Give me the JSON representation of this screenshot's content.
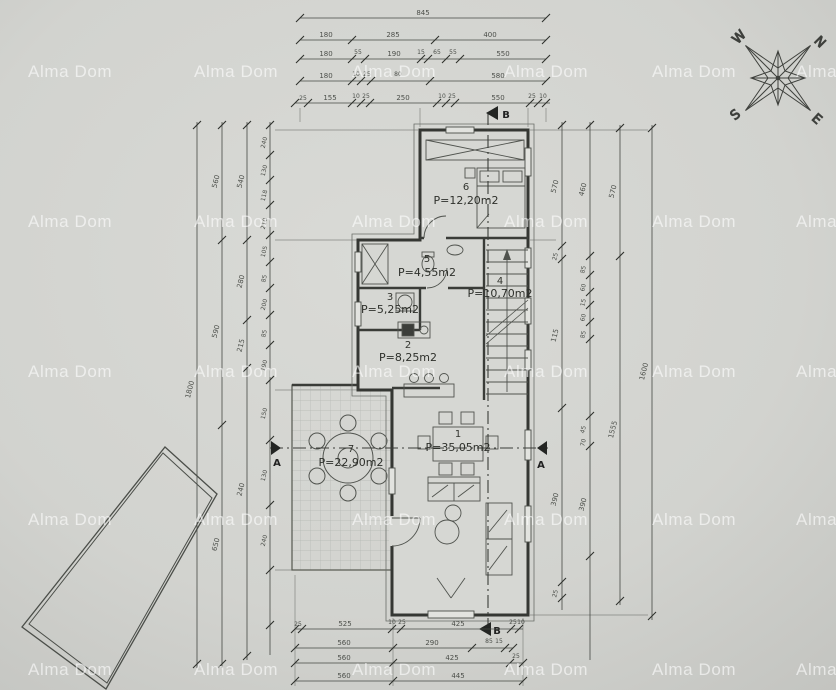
{
  "watermark": {
    "text": "Alma Dom"
  },
  "compass": {
    "n": "N",
    "w": "W",
    "s": "S",
    "e": "E"
  },
  "sections": {
    "b_top": "B",
    "b_bottom": "B",
    "a_left": "A",
    "a_right": "A"
  },
  "rooms": {
    "r1": {
      "num": "1",
      "area": "P=35,05m2"
    },
    "r2": {
      "num": "2",
      "area": "P=8,25m2"
    },
    "r3": {
      "num": "3",
      "area": "P=5,25m2"
    },
    "r4": {
      "num": "4",
      "area": "P=10,70m2"
    },
    "r5": {
      "num": "5",
      "area": "P=4,55m2"
    },
    "r6": {
      "num": "6",
      "area": "P=12,20m2"
    },
    "r7": {
      "num": "7",
      "area": "P=22,90m2"
    }
  },
  "dims": {
    "top1": [
      "845"
    ],
    "top2": [
      "180",
      "285",
      "400"
    ],
    "top3": [
      "180",
      "55",
      "190",
      "15",
      "65",
      "55",
      "550"
    ],
    "top4": [
      "180",
      "10",
      "25",
      "80",
      "580"
    ],
    "top5": [
      "25",
      "155",
      "10",
      "25",
      "250",
      "10",
      "25",
      "550",
      "25",
      "10"
    ],
    "bottom1": [
      "25",
      "525",
      "10",
      "25",
      "425",
      "25",
      "10"
    ],
    "bottom2": [
      "560",
      "290",
      "85",
      "15"
    ],
    "bottom3": [
      "560",
      "425",
      "25"
    ],
    "bottom4": [
      "560",
      "445"
    ],
    "left1": [
      "1800"
    ],
    "left2": [
      "560",
      "590",
      "650"
    ],
    "left3": [
      "540",
      "280",
      "215",
      "240"
    ],
    "left4": [
      "240",
      "130",
      "118",
      "210",
      "105",
      "85",
      "200",
      "85",
      "190",
      "150",
      "130",
      "240"
    ],
    "right1": [
      "570",
      "25",
      "115",
      "390",
      "25"
    ],
    "right2": [
      "460",
      "85",
      "60",
      "15",
      "60",
      "85",
      "45",
      "70",
      "390"
    ],
    "right3": [
      "570",
      "1555"
    ],
    "right4": [
      "1600"
    ]
  }
}
